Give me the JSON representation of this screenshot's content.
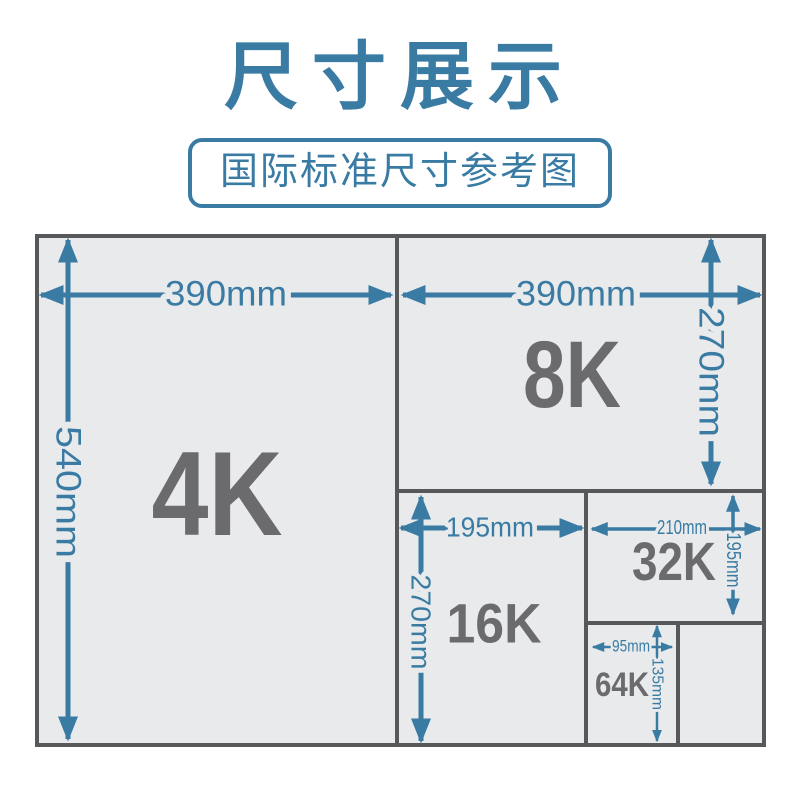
{
  "title": "尺寸展示",
  "subtitle": "国际标准尺寸参考图",
  "colors": {
    "accent_blue": "#3a7ba4",
    "paper_fill": "#e9eaeb",
    "paper_outline": "#57585a",
    "size_label_gray": "#6b6b6d",
    "page_background": "#ffffff"
  },
  "panels": [
    {
      "id": "4K",
      "label": "4K",
      "width_label": "390mm",
      "height_label": "540mm"
    },
    {
      "id": "8K",
      "label": "8K",
      "width_label": "390mm",
      "height_label": "270mm"
    },
    {
      "id": "16K",
      "label": "16K",
      "width_label": "195mm",
      "height_label": "270mm"
    },
    {
      "id": "32K",
      "label": "32K",
      "width_label": "210mm",
      "height_label": "195mm"
    },
    {
      "id": "64K",
      "label": "64K",
      "width_label": "95mm",
      "height_label": "135mm"
    }
  ]
}
